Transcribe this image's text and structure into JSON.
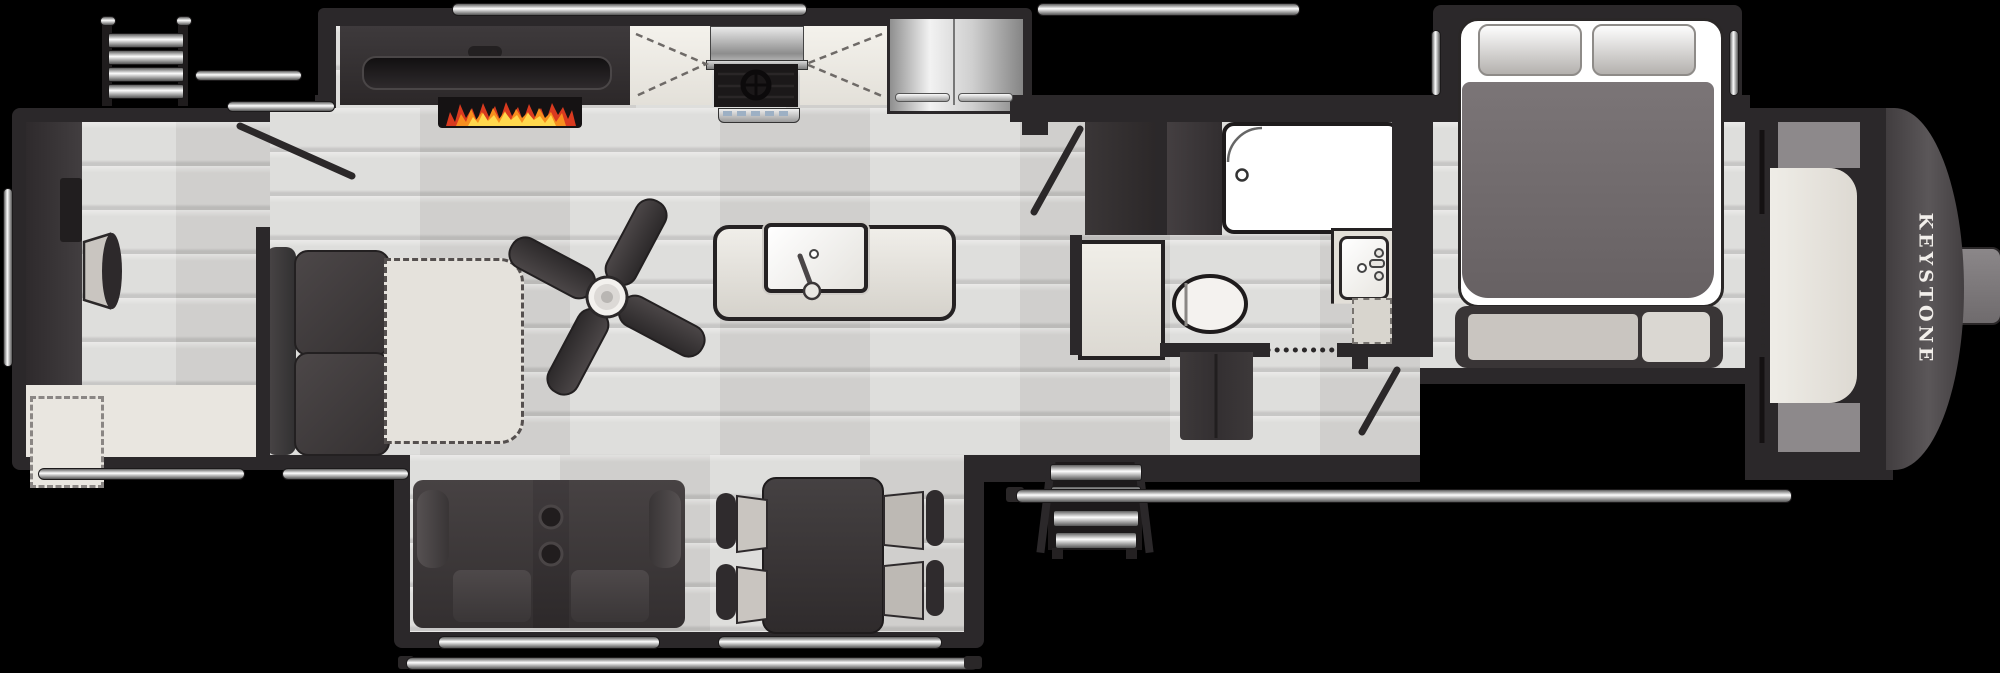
{
  "title": "Fifth wheel RV floor plan",
  "brand": {
    "front_cap_label": "KEYSTONE"
  },
  "colors": {
    "background": "#000000",
    "wall": "#2b282a",
    "wall_light": "#3a3637",
    "floor": "#d9d8d6",
    "slide_beige": "#e9e6e0",
    "counter": "#e3e0d9",
    "cushion": "#c9c5c0",
    "dark_furniture": "#363233",
    "white": "#ffffff",
    "steel": "#c9c9c9",
    "cap": "#534f51",
    "flame_red": "#d93a1f",
    "flame_orange": "#f78f1e",
    "flame_yellow": "#ffd84d"
  },
  "floorplan": {
    "type": "fifth-wheel travel trailer",
    "rooms": {
      "rear_living": {
        "items": [
          "rear-entertainment-cabinet",
          "accent-chair",
          "theater-seating",
          "desk-slide-area"
        ]
      },
      "kitchen": {
        "items": [
          "fireplace",
          "tv",
          "kitchen-counter",
          "range-cooktop",
          "refrigerator",
          "island-sink",
          "ceiling-fan"
        ]
      },
      "dinette_slide": {
        "items": [
          "sofa-with-console",
          "dinette-table",
          "dinette-chairs"
        ]
      },
      "bathroom": {
        "items": [
          "shower",
          "toilet",
          "vanity-sink",
          "linen-closet",
          "pantry"
        ]
      },
      "bedroom": {
        "items": [
          "queen-bed",
          "pillows",
          "foot-bench",
          "front-wardrobe"
        ]
      }
    },
    "exterior": [
      "rear-ladder",
      "awning-rails",
      "entry-steps",
      "grab-handles",
      "hitch-pin-box"
    ]
  }
}
